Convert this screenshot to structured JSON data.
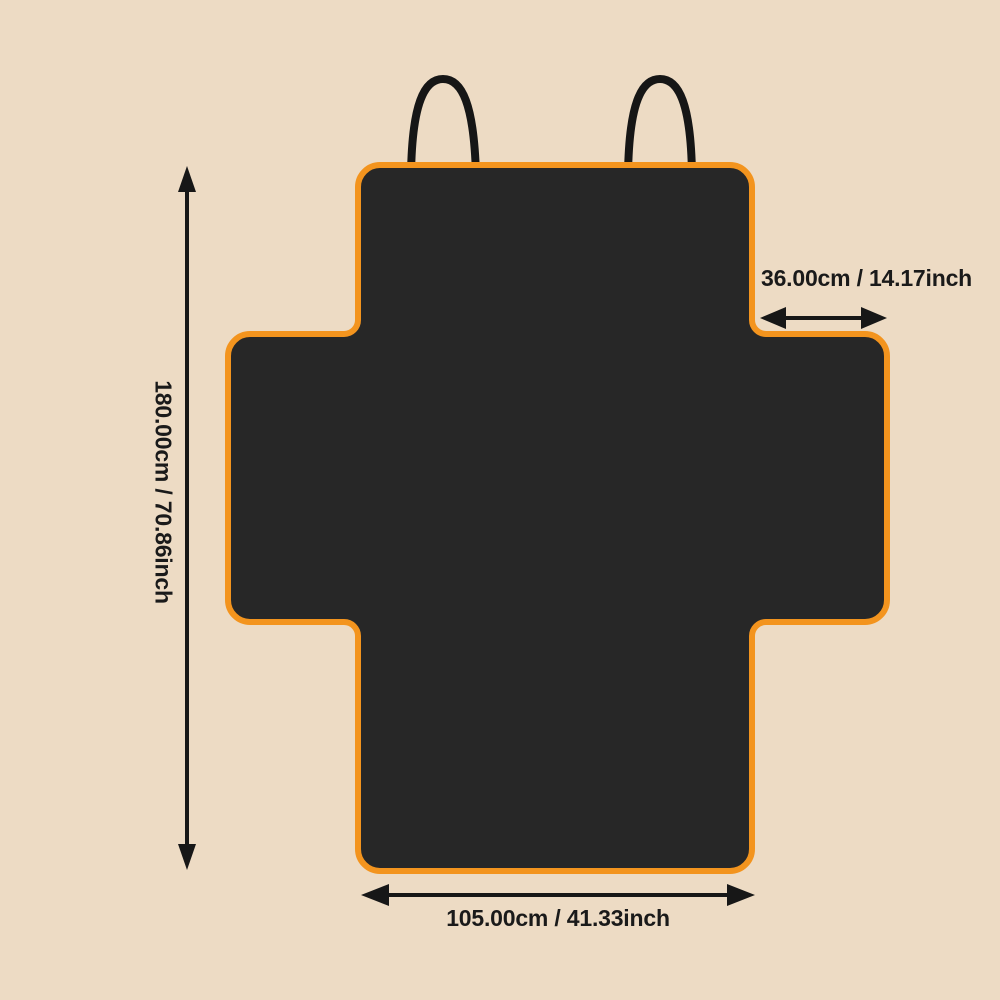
{
  "canvas": {
    "background_color": "#EDDBC4"
  },
  "seat_cover": {
    "fill_color": "#272727",
    "trim_color": "#F3941E",
    "strap_color": "#161616",
    "strap_count": 2
  },
  "annotations": {
    "text_color": "#1a1a1a",
    "height": {
      "text": "180.00cm / 70.86inch",
      "cm": "180.00",
      "inch": "70.86",
      "orientation": "vertical"
    },
    "flap_width": {
      "text": "36.00cm / 14.17inch",
      "cm": "36.00",
      "inch": "14.17",
      "orientation": "horizontal"
    },
    "bottom_width": {
      "text": "105.00cm / 41.33inch",
      "cm": "105.00",
      "inch": "41.33",
      "orientation": "horizontal"
    }
  }
}
